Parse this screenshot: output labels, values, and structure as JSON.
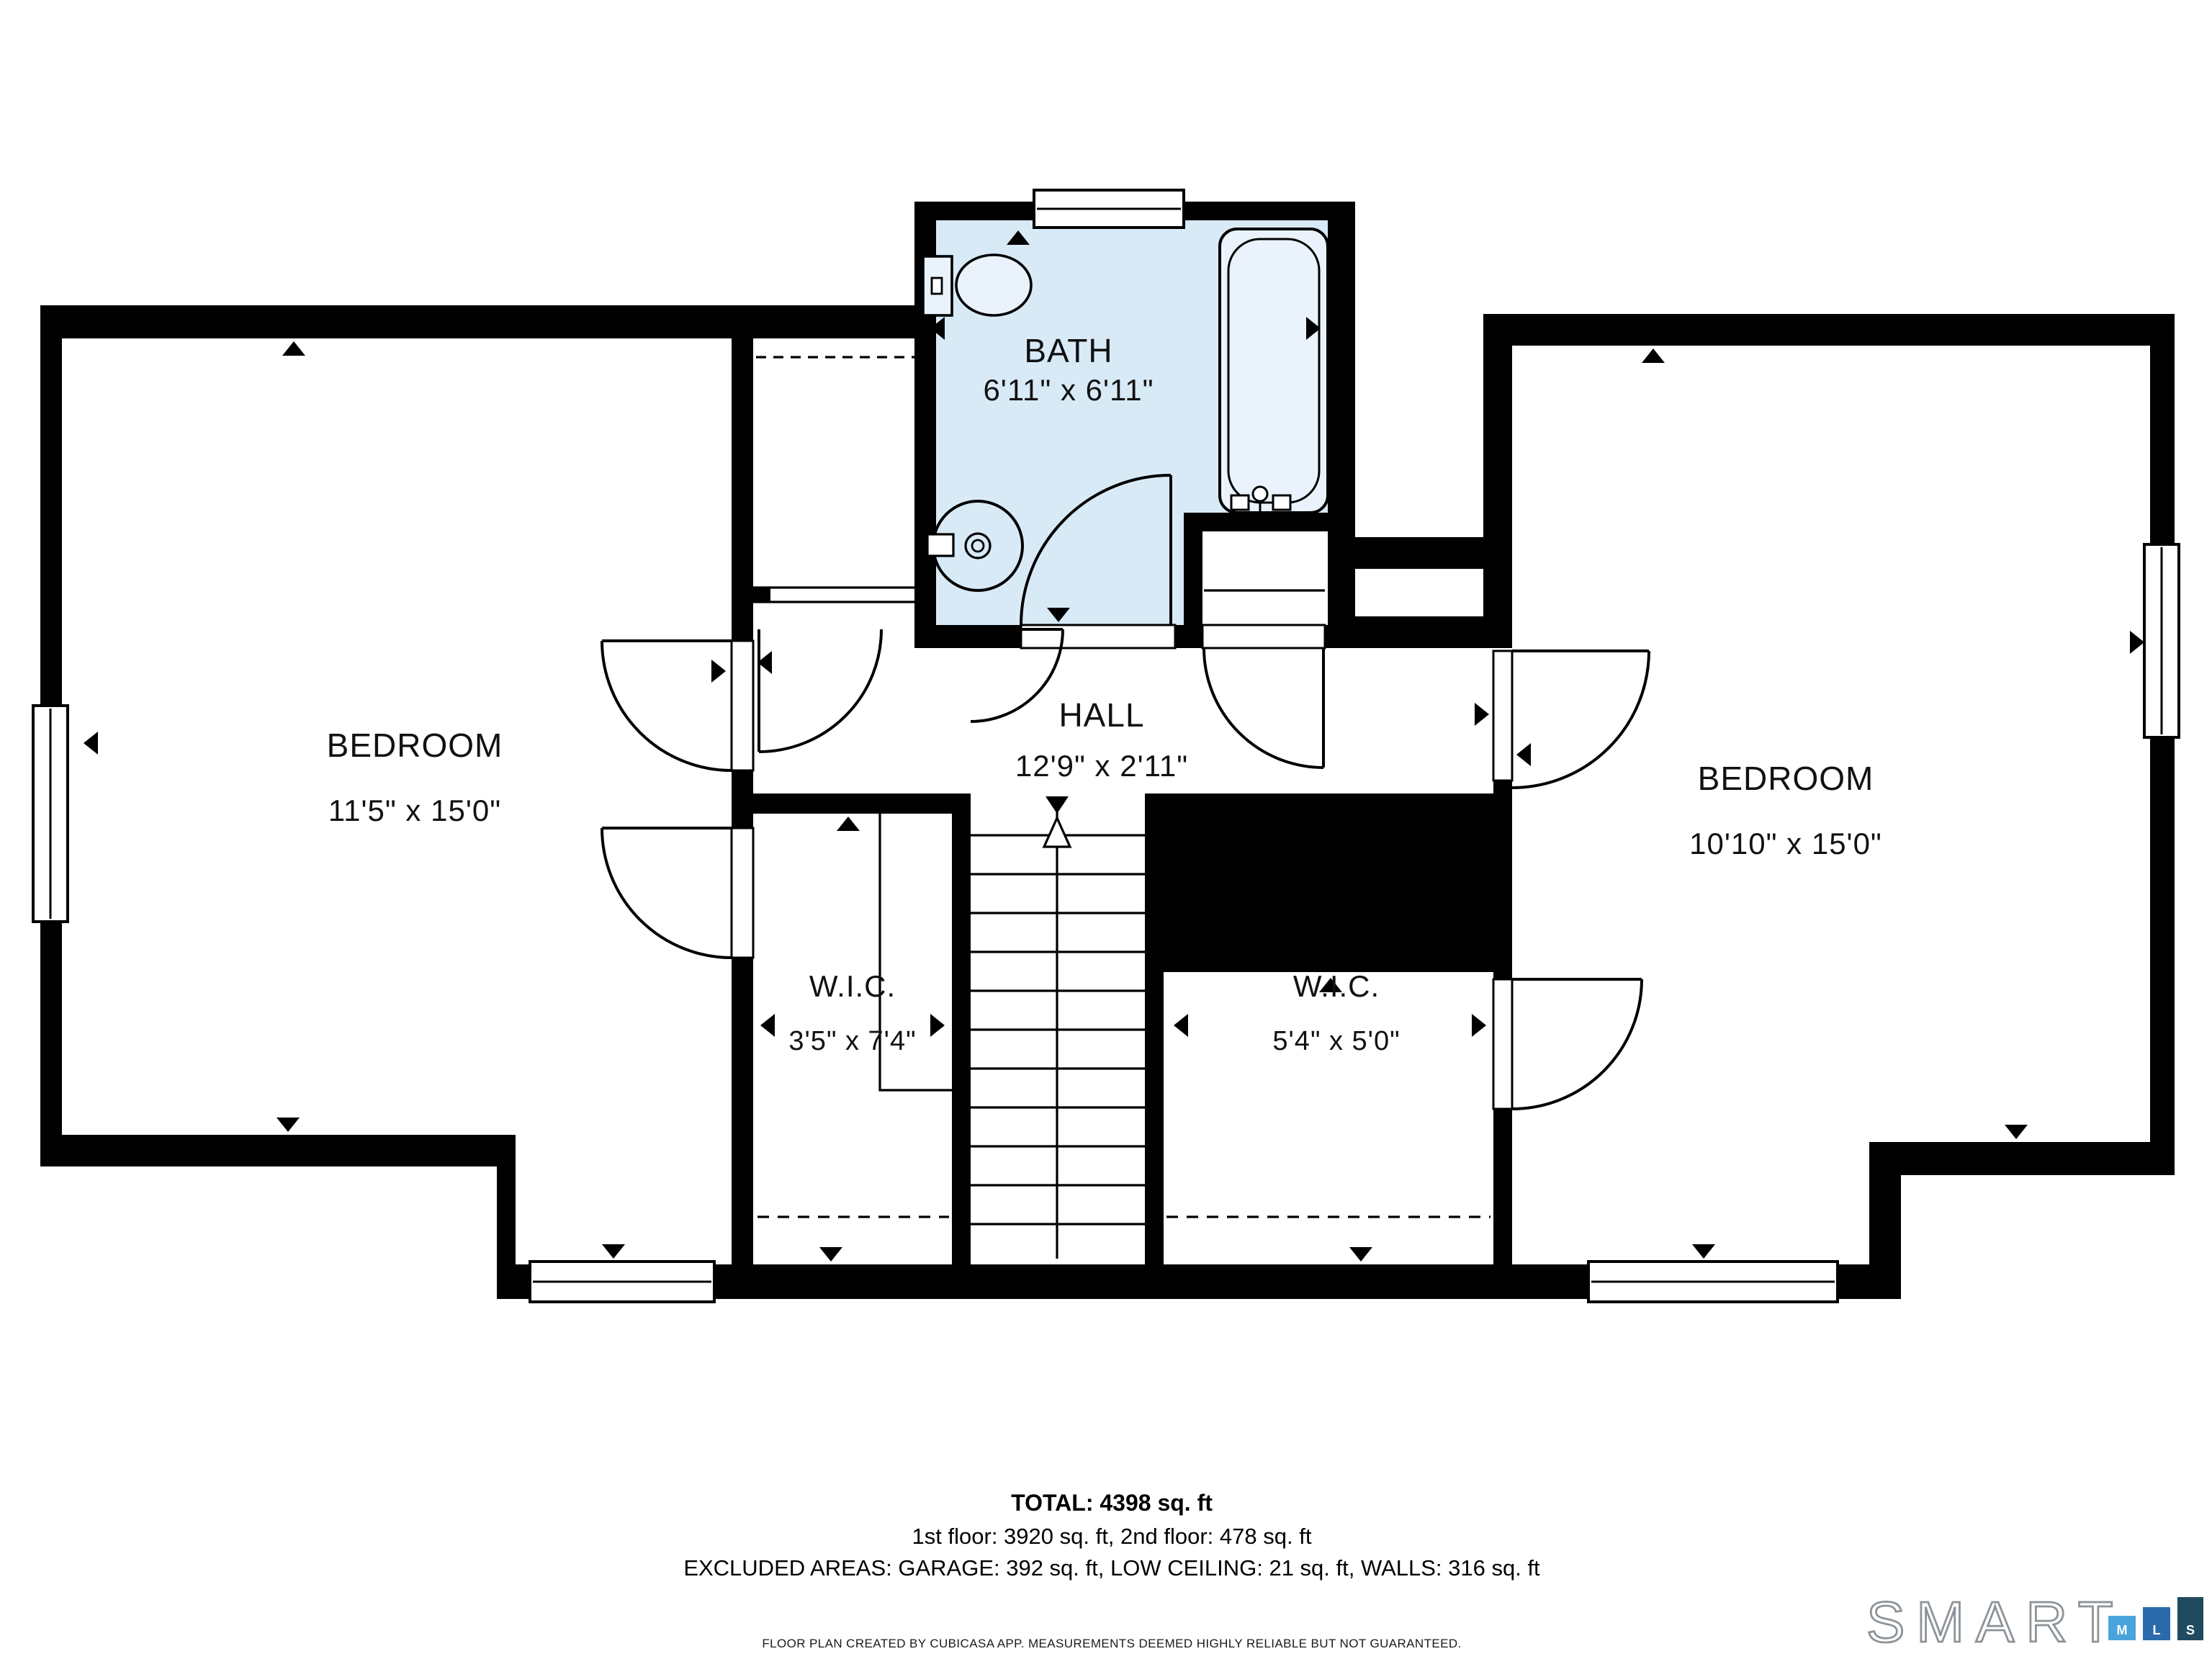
{
  "rooms": {
    "bath": {
      "name": "BATH",
      "dims": "6'11\" x 6'11\""
    },
    "hall": {
      "name": "HALL",
      "dims": "12'9\" x 2'11\""
    },
    "bedroom_left": {
      "name": "BEDROOM",
      "dims": "11'5\" x 15'0\""
    },
    "bedroom_right": {
      "name": "BEDROOM",
      "dims": "10'10\" x 15'0\""
    },
    "wic_left": {
      "name": "W.I.C.",
      "dims": "3'5\" x 7'4\""
    },
    "wic_right": {
      "name": "W.I.C.",
      "dims": "5'4\" x 5'0\""
    }
  },
  "summary": {
    "total": "TOTAL: 4398 sq. ft",
    "floors": "1st floor: 3920 sq. ft, 2nd floor: 478 sq. ft",
    "excluded": "EXCLUDED AREAS: GARAGE: 392 sq. ft, LOW CEILING: 21 sq. ft, WALLS: 316 sq. ft"
  },
  "disclaimer": "FLOOR PLAN CREATED BY CUBICASA APP. MEASUREMENTS DEEMED HIGHLY RELIABLE BUT NOT GUARANTEED.",
  "logo": {
    "wordmark": "SMART",
    "bars": [
      {
        "letter": "M",
        "color": "#4ba3dc"
      },
      {
        "letter": "L",
        "color": "#2a6cab"
      },
      {
        "letter": "S",
        "color": "#204a5f"
      }
    ]
  },
  "colors": {
    "bath_fill": "#d9eaf7",
    "fixture_fill": "#eaf3fb",
    "wall": "#000000",
    "background": "#ffffff"
  }
}
